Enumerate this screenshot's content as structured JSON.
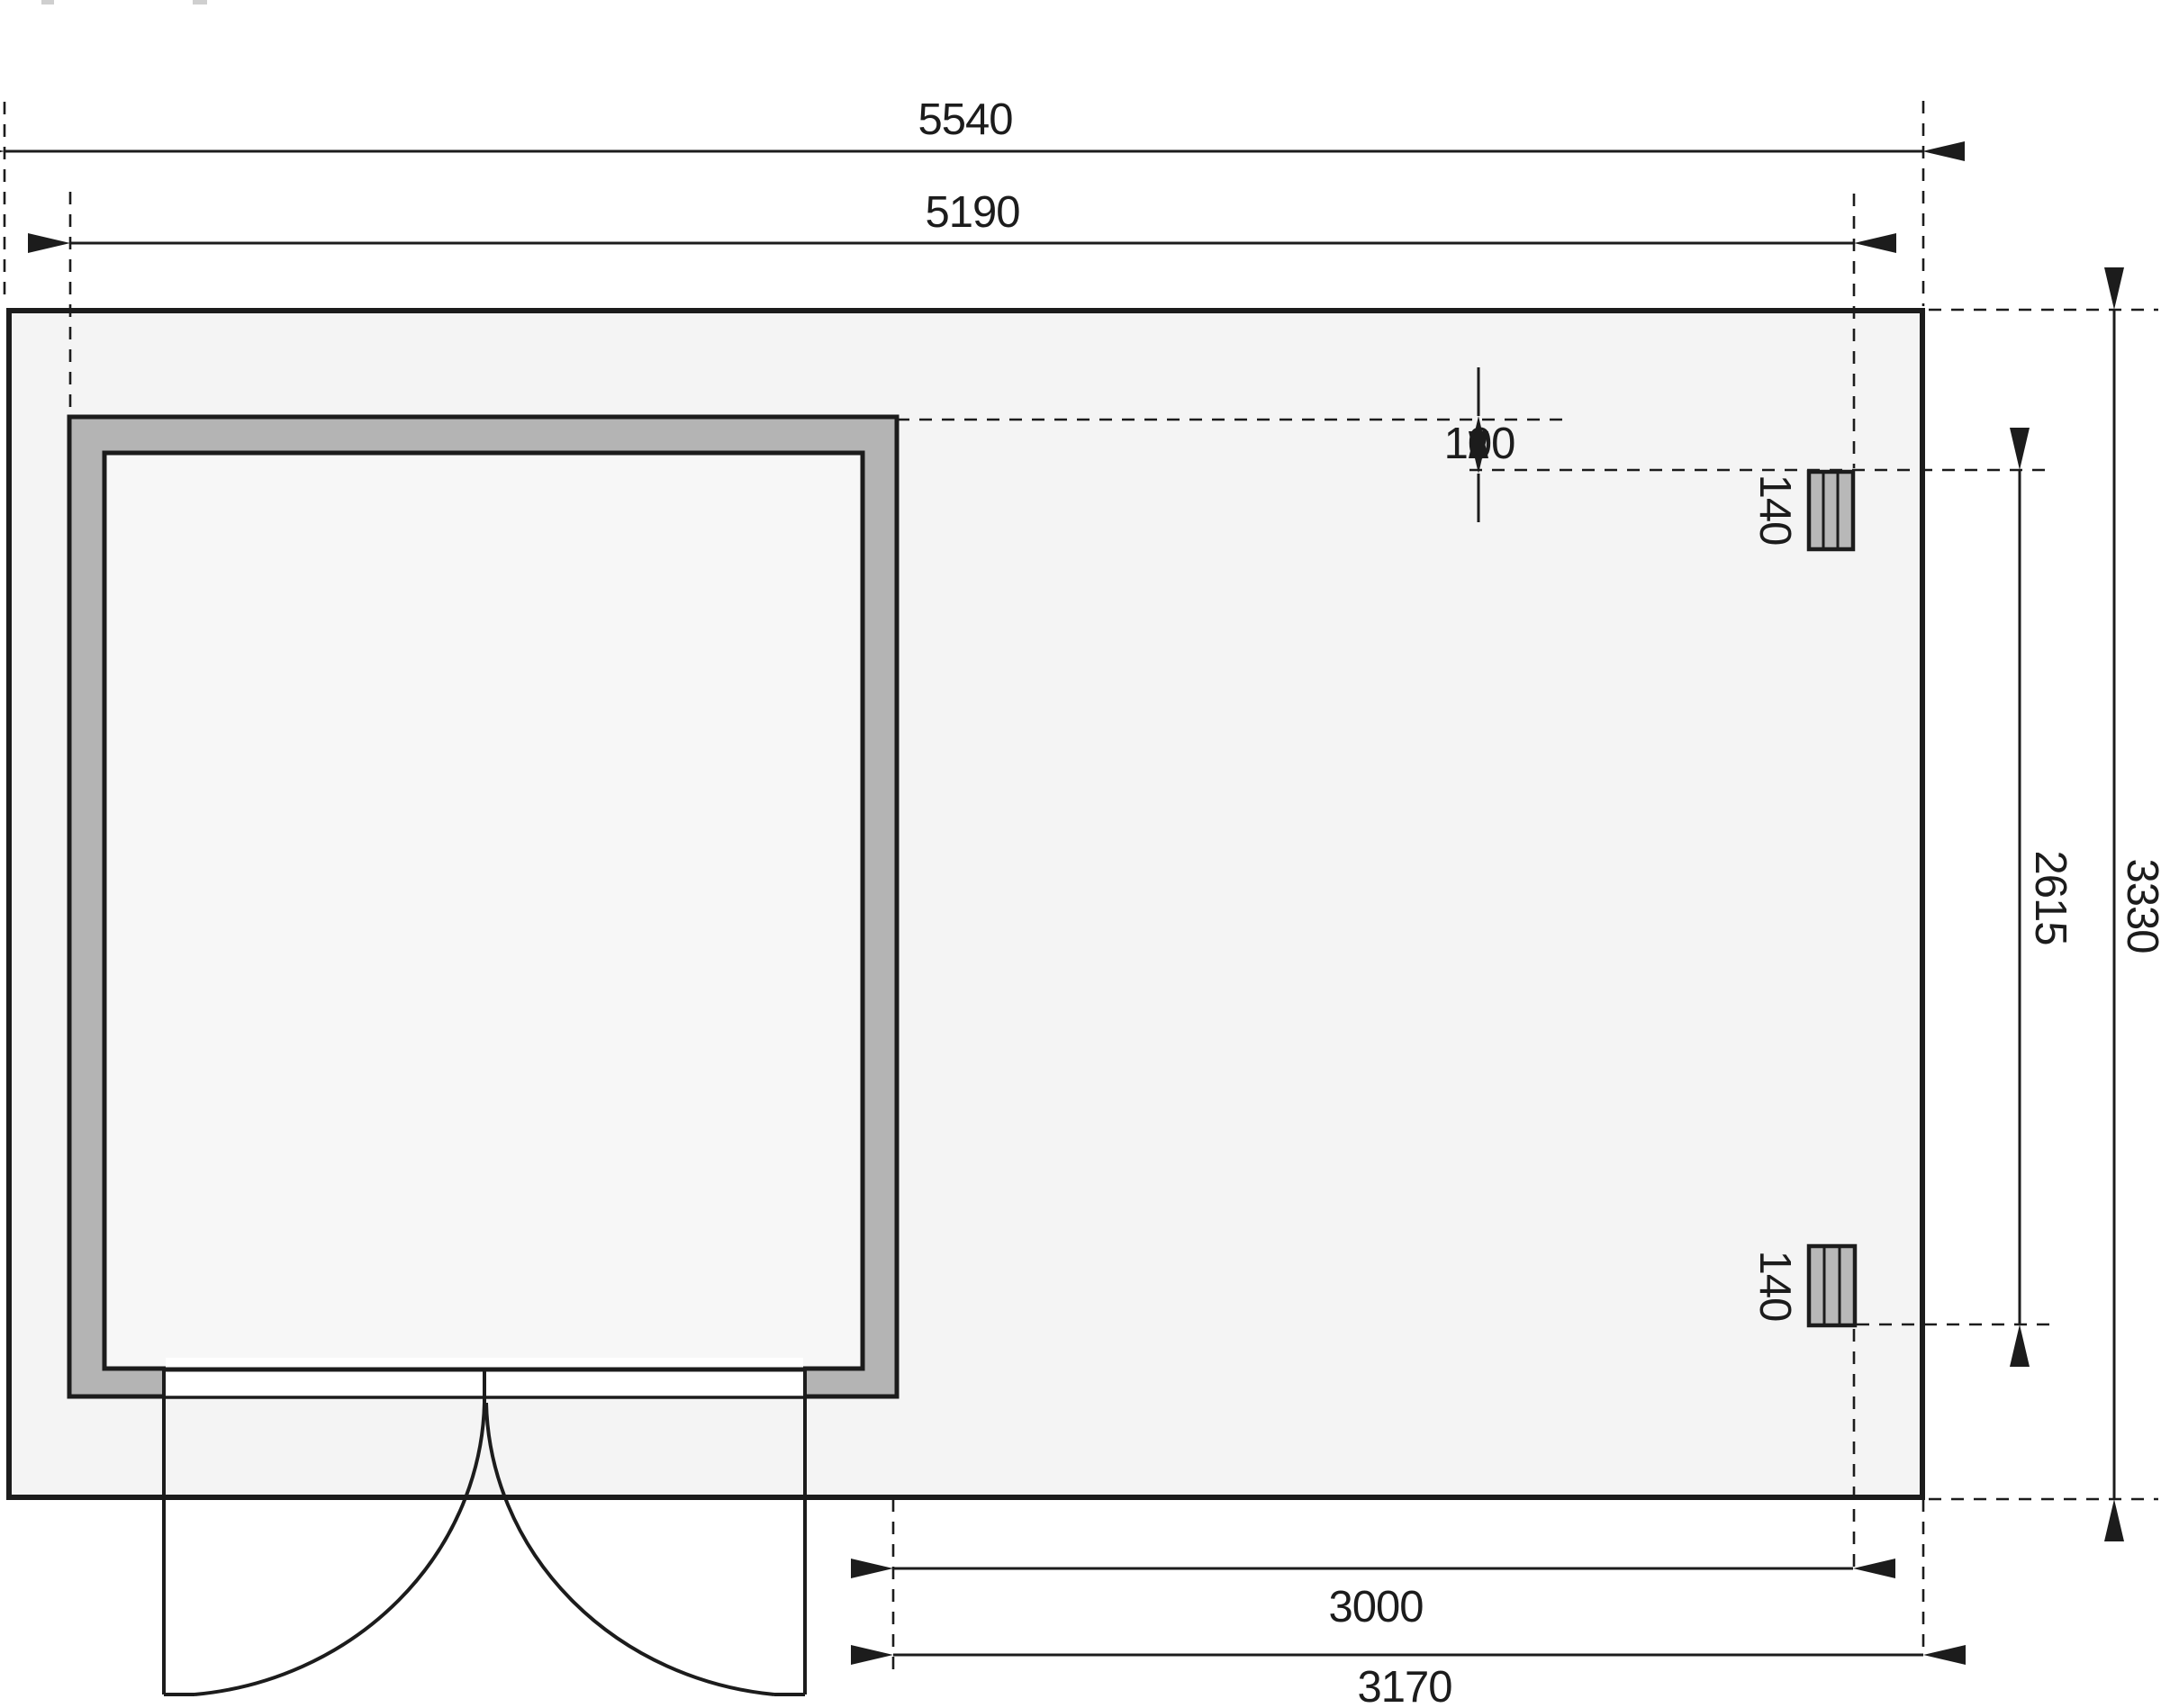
{
  "drawing": {
    "type": "floor-plan",
    "description": "Garden shed with side annex roof, top view dimension drawing",
    "dims": {
      "overall_width": "5540",
      "shell_width": "5190",
      "roof_offset": "100",
      "post_size_top": "140",
      "post_size_bottom": "140",
      "post_span": "2615",
      "overall_depth": "3330",
      "annex_clear_width": "3000",
      "annex_total_width": "3170"
    },
    "colors": {
      "line": "#1c1c1c",
      "floor_fill": "#f4f4f4",
      "wall_fill": "#b4b4b4",
      "room_fill": "#f7f7f7",
      "post_fill": "#b8b8b8",
      "opening_fill": "#ffffff"
    }
  }
}
